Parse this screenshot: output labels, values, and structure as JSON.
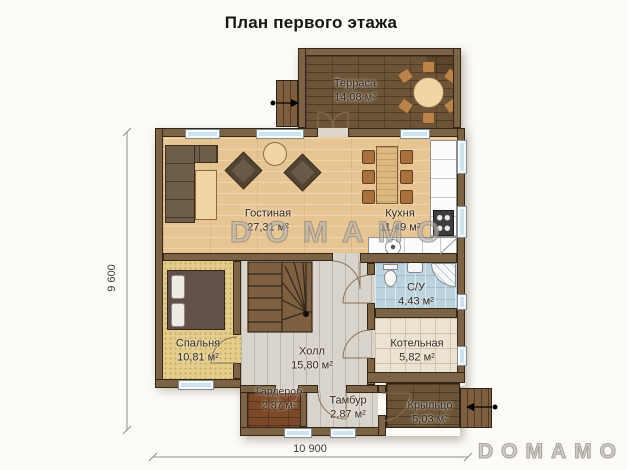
{
  "title": "План первого этажа",
  "watermarks": {
    "center": "DOMAMO",
    "corner": "DOMAMO"
  },
  "dimensions": {
    "vertical": "9 600",
    "horizontal": "10 900"
  },
  "rooms": {
    "terrace": {
      "name": "Терраса",
      "area": "14,08 м²"
    },
    "living": {
      "name": "Гостиная",
      "area": "27,31 м²"
    },
    "kitchen": {
      "name": "Кухня",
      "area": "11,49 м²"
    },
    "bathroom": {
      "name": "С/У",
      "area": "4,43 м²"
    },
    "bedroom": {
      "name": "Спальня",
      "area": "10,81 м²"
    },
    "hall": {
      "name": "Холл",
      "area": "15,80 м²"
    },
    "boiler": {
      "name": "Котельная",
      "area": "5,82 м²"
    },
    "wardrobe": {
      "name": "Гардероб",
      "area": "2,87 м²"
    },
    "vestibule": {
      "name": "Тамбур",
      "area": "2,87 м²"
    },
    "porch": {
      "name": "Крыльцо",
      "area": "5,03 м²"
    }
  },
  "colors": {
    "wall": "#7c6345",
    "wood": "#e7c593",
    "deck": "#6d5438",
    "carpet": "#e4cd8a",
    "hall": "#d9d4cb",
    "tile": "#ebe2d1",
    "bath": "#bad3de",
    "window": "#cfe3ee",
    "stairs": "#7e5f3f"
  }
}
